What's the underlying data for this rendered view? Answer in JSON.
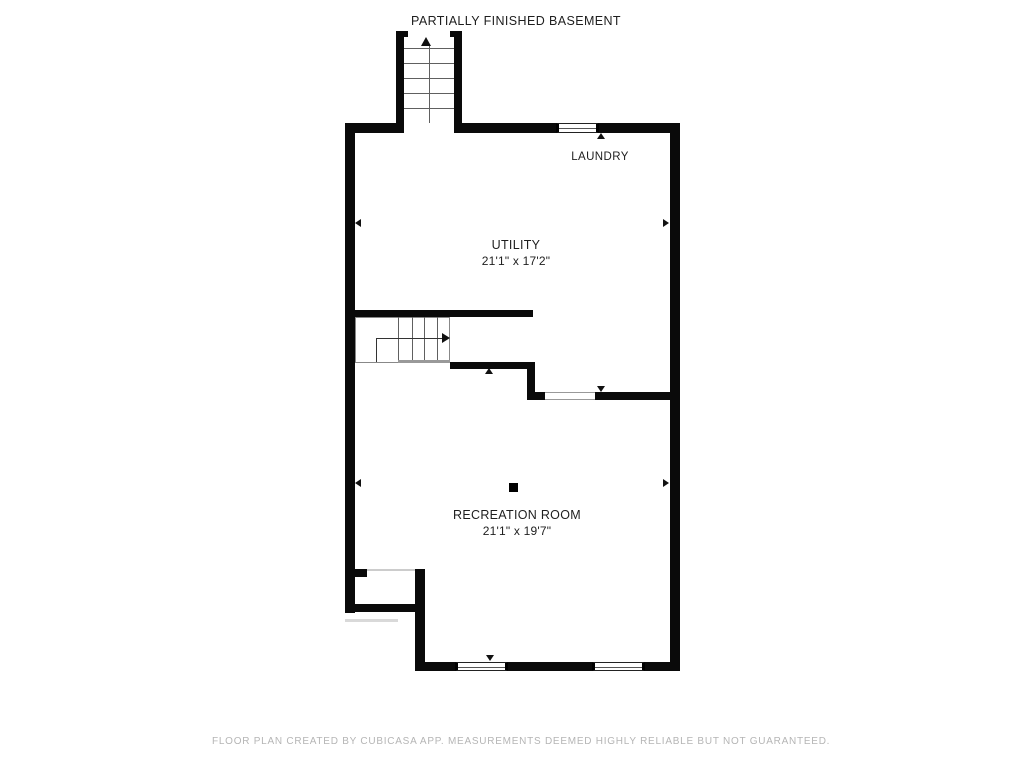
{
  "plan": {
    "title": "PARTIALLY FINISHED BASEMENT",
    "footer": "FLOOR PLAN CREATED BY CUBICASA APP. MEASUREMENTS DEEMED HIGHLY RELIABLE BUT NOT GUARANTEED."
  },
  "rooms": {
    "laundry": {
      "name": "LAUNDRY"
    },
    "utility": {
      "name": "UTILITY",
      "dims": "21'1\" x 17'2\""
    },
    "recreation": {
      "name": "RECREATION ROOM",
      "dims": "21'1\" x 19'7\""
    }
  },
  "colors": {
    "wall": "#0a0a0a",
    "label": "#1e1e1e",
    "footer": "#b5b5b5",
    "stair": "#606060",
    "arrow": "#111111"
  }
}
